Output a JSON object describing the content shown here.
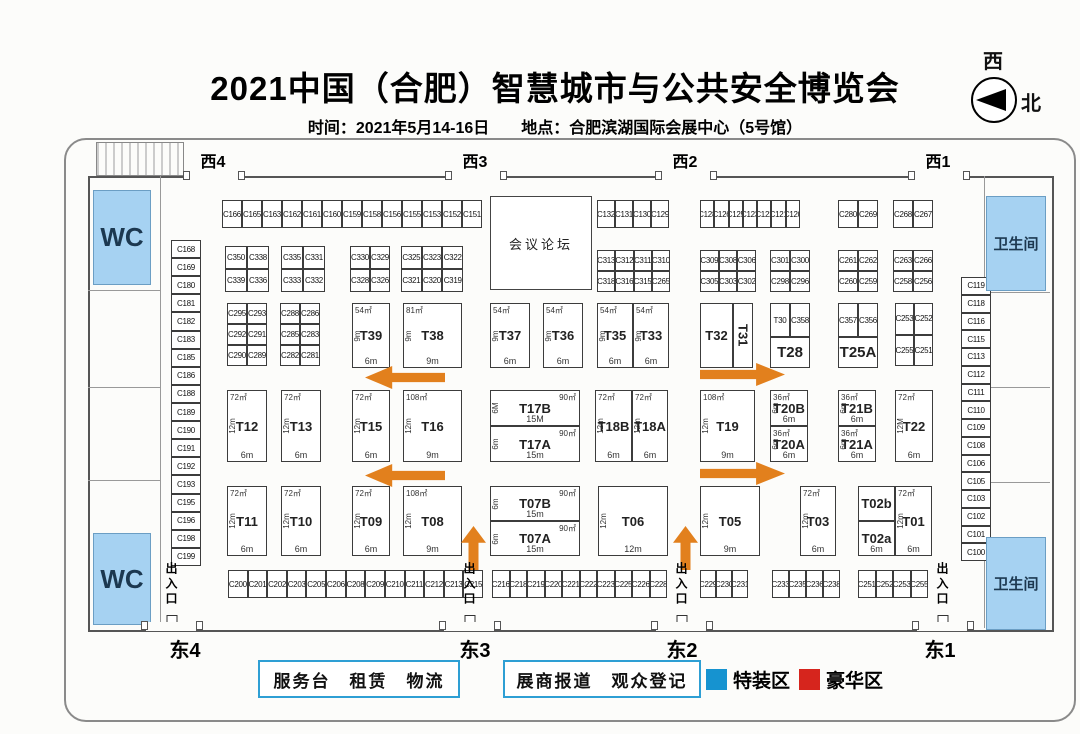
{
  "header": {
    "title": "2021中国（合肥）智慧城市与公共安全博览会",
    "subtitle": "时间：2021年5月14-16日　　地点：合肥滨湖国际会展中心（5号馆）",
    "compass_top": "西",
    "compass_right": "北"
  },
  "legend": {
    "service_box": "服务台　租赁　物流",
    "registration_box": "展商报道　观众登记",
    "special_zone_label": "特装区",
    "special_zone_color": "#1693d0",
    "deluxe_zone_label": "豪华区",
    "deluxe_zone_color": "#d6251d"
  },
  "colors": {
    "arrow_orange": "#e2801d",
    "wc_blue": "#a6d2f2"
  },
  "gates": {
    "top": [
      {
        "label": "西4",
        "x": 213
      },
      {
        "label": "西3",
        "x": 475
      },
      {
        "label": "西2",
        "x": 685
      },
      {
        "label": "西1",
        "x": 938
      }
    ],
    "bottom": [
      {
        "label": "东4",
        "x": 185
      },
      {
        "label": "东3",
        "x": 475
      },
      {
        "label": "东2",
        "x": 682
      },
      {
        "label": "东1",
        "x": 940
      }
    ]
  },
  "plan": {
    "entrance_label": "出入口",
    "entrances": [
      {
        "x": 163,
        "y": 562
      },
      {
        "x": 461,
        "y": 562
      },
      {
        "x": 673,
        "y": 562
      },
      {
        "x": 934,
        "y": 562
      }
    ],
    "conference": {
      "label": "会议论坛",
      "x": 490,
      "y": 196,
      "w": 102,
      "h": 94
    },
    "wc": [
      {
        "label": "WC",
        "x": 93,
        "y": 190,
        "w": 58,
        "h": 95
      },
      {
        "label": "WC",
        "x": 93,
        "y": 533,
        "w": 58,
        "h": 92
      },
      {
        "label": "卫生间",
        "x": 986,
        "y": 196,
        "w": 60,
        "h": 95
      },
      {
        "label": "卫生间",
        "x": 986,
        "y": 537,
        "w": 60,
        "h": 93
      }
    ],
    "strips": [
      {
        "x": 222,
        "y": 200,
        "w": 260,
        "h": 28,
        "cells": [
          "C166",
          "C165",
          "C163",
          "C162",
          "C161",
          "C160",
          "C159",
          "C158",
          "C156",
          "C155",
          "C153",
          "C152",
          "C151"
        ]
      },
      {
        "x": 597,
        "y": 200,
        "w": 72,
        "h": 28,
        "cells": [
          "C132",
          "C131",
          "C130",
          "C129"
        ]
      },
      {
        "x": 700,
        "y": 200,
        "w": 100,
        "h": 28,
        "cells": [
          "C128",
          "C126",
          "C125",
          "C123",
          "C122",
          "C121",
          "C120"
        ]
      },
      {
        "x": 838,
        "y": 200,
        "w": 40,
        "h": 28,
        "cells": [
          "C280",
          "C269"
        ]
      },
      {
        "x": 893,
        "y": 200,
        "w": 40,
        "h": 28,
        "cells": [
          "C268",
          "C267"
        ]
      },
      {
        "x": 171,
        "y": 240,
        "w": 30,
        "h": 326,
        "vertical": true,
        "cells": [
          "C168",
          "C169",
          "C180",
          "C181",
          "C182",
          "C183",
          "C185",
          "C186",
          "C188",
          "C189",
          "C190",
          "C191",
          "C192",
          "C193",
          "C195",
          "C196",
          "C198",
          "C199"
        ]
      },
      {
        "x": 961,
        "y": 277,
        "w": 30,
        "h": 284,
        "vertical": true,
        "cells": [
          "C119",
          "C118",
          "C116",
          "C115",
          "C113",
          "C112",
          "C111",
          "C110",
          "C109",
          "C108",
          "C106",
          "C105",
          "C103",
          "C102",
          "C101",
          "C100"
        ]
      },
      {
        "x": 228,
        "y": 570,
        "w": 255,
        "h": 28,
        "cells": [
          "C200",
          "C201",
          "C202",
          "C203",
          "C205",
          "C206",
          "C208",
          "C209",
          "C210",
          "C211",
          "C212",
          "C213",
          "C215"
        ]
      },
      {
        "x": 492,
        "y": 570,
        "w": 175,
        "h": 28,
        "cells": [
          "C216",
          "C218",
          "C219",
          "C220",
          "C221",
          "C222",
          "C223",
          "C225",
          "C226",
          "C228"
        ]
      },
      {
        "x": 700,
        "y": 570,
        "w": 48,
        "h": 28,
        "cells": [
          "C229",
          "C230",
          "C231"
        ]
      },
      {
        "x": 772,
        "y": 570,
        "w": 68,
        "h": 28,
        "cells": [
          "C233",
          "C235",
          "C236",
          "C238"
        ]
      },
      {
        "x": 858,
        "y": 570,
        "w": 70,
        "h": 28,
        "cells": [
          "C251",
          "C252",
          "C253",
          "C255"
        ]
      }
    ],
    "grids": [
      {
        "x": 225,
        "y": 246,
        "w": 44,
        "h": 46,
        "rows": [
          [
            "C350",
            "C338"
          ],
          [
            "C339",
            "C336"
          ]
        ]
      },
      {
        "x": 281,
        "y": 246,
        "w": 44,
        "h": 46,
        "rows": [
          [
            "C335",
            "C331"
          ],
          [
            "C333",
            "C332"
          ]
        ]
      },
      {
        "x": 350,
        "y": 246,
        "w": 40,
        "h": 46,
        "rows": [
          [
            "C330",
            "C329"
          ],
          [
            "C328",
            "C326"
          ]
        ]
      },
      {
        "x": 401,
        "y": 246,
        "w": 62,
        "h": 46,
        "rows": [
          [
            "C325",
            "C323",
            "C322"
          ],
          [
            "C321",
            "C320",
            "C319"
          ]
        ]
      },
      {
        "x": 597,
        "y": 250,
        "w": 73,
        "h": 42,
        "rows": [
          [
            "C313",
            "C312",
            "C311",
            "C310"
          ],
          [
            "C318",
            "C316",
            "C315",
            "C265"
          ]
        ]
      },
      {
        "x": 700,
        "y": 250,
        "w": 56,
        "h": 42,
        "rows": [
          [
            "C309",
            "C308",
            "C306"
          ],
          [
            "C305",
            "C303",
            "C302"
          ]
        ]
      },
      {
        "x": 770,
        "y": 250,
        "w": 40,
        "h": 42,
        "rows": [
          [
            "C301",
            "C300"
          ],
          [
            "C298",
            "C296"
          ]
        ]
      },
      {
        "x": 838,
        "y": 250,
        "w": 40,
        "h": 42,
        "rows": [
          [
            "C261",
            "C262"
          ],
          [
            "C260",
            "C259"
          ]
        ]
      },
      {
        "x": 893,
        "y": 250,
        "w": 40,
        "h": 42,
        "rows": [
          [
            "C263",
            "C266"
          ],
          [
            "C258",
            "C256"
          ]
        ]
      },
      {
        "x": 227,
        "y": 303,
        "w": 40,
        "h": 63,
        "rows": [
          [
            "C295",
            "C293"
          ],
          [
            "C292",
            "C291"
          ],
          [
            "C290",
            "C289"
          ]
        ]
      },
      {
        "x": 280,
        "y": 303,
        "w": 40,
        "h": 63,
        "rows": [
          [
            "C288",
            "C286"
          ],
          [
            "C285",
            "C283"
          ],
          [
            "C282",
            "C281"
          ]
        ]
      },
      {
        "x": 895,
        "y": 303,
        "w": 38,
        "h": 63,
        "rows": [
          [
            "C253",
            "C252"
          ],
          [
            "C255",
            "C251"
          ]
        ]
      },
      {
        "x": 770,
        "y": 303,
        "w": 40,
        "h": 34,
        "rows": [
          [
            "T30",
            "C358"
          ]
        ]
      },
      {
        "x": 838,
        "y": 303,
        "w": 40,
        "h": 34,
        "rows": [
          [
            "C357",
            "C356"
          ]
        ]
      }
    ],
    "tbooths": [
      {
        "l": "T39",
        "x": 352,
        "y": 303,
        "w": 38,
        "h": 65,
        "a": "54㎡",
        "s": "9m",
        "b": "6m"
      },
      {
        "l": "T38",
        "x": 403,
        "y": 303,
        "w": 59,
        "h": 65,
        "a": "81㎡",
        "s": "9m",
        "b": "9m"
      },
      {
        "l": "T37",
        "x": 490,
        "y": 303,
        "w": 40,
        "h": 65,
        "a": "54㎡",
        "s": "9m",
        "b": "6m"
      },
      {
        "l": "T36",
        "x": 543,
        "y": 303,
        "w": 40,
        "h": 65,
        "a": "54㎡",
        "s": "9m",
        "b": "6m"
      },
      {
        "l": "T35",
        "x": 597,
        "y": 303,
        "w": 36,
        "h": 65,
        "a": "54㎡",
        "s": "9m",
        "b": "6m"
      },
      {
        "l": "T33",
        "x": 633,
        "y": 303,
        "w": 36,
        "h": 65,
        "a": "54㎡",
        "s": "9m",
        "b": "6m"
      },
      {
        "l": "T32",
        "x": 700,
        "y": 303,
        "w": 33,
        "h": 65
      },
      {
        "l": "T31",
        "x": 733,
        "y": 303,
        "w": 20,
        "h": 65,
        "rot": true
      },
      {
        "l": "T28",
        "x": 770,
        "y": 337,
        "w": 40,
        "h": 31,
        "big": true
      },
      {
        "l": "T25A",
        "x": 838,
        "y": 337,
        "w": 40,
        "h": 31,
        "big": true
      },
      {
        "l": "T12",
        "x": 227,
        "y": 390,
        "w": 40,
        "h": 72,
        "a": "72㎡",
        "s": "12m",
        "b": "6m"
      },
      {
        "l": "T13",
        "x": 281,
        "y": 390,
        "w": 40,
        "h": 72,
        "a": "72㎡",
        "s": "12m",
        "b": "6m"
      },
      {
        "l": "T15",
        "x": 352,
        "y": 390,
        "w": 38,
        "h": 72,
        "a": "72㎡",
        "s": "12m",
        "b": "6m"
      },
      {
        "l": "T16",
        "x": 403,
        "y": 390,
        "w": 59,
        "h": 72,
        "a": "108㎡",
        "s": "12m",
        "b": "9m"
      },
      {
        "l": "T17B",
        "x": 490,
        "y": 390,
        "w": 90,
        "h": 36,
        "a": "90㎡",
        "ar": true,
        "s": "6M",
        "b": "15M"
      },
      {
        "l": "T17A",
        "x": 490,
        "y": 426,
        "w": 90,
        "h": 36,
        "a": "90㎡",
        "ar": true,
        "s": "6m",
        "b": "15m"
      },
      {
        "l": "T18B",
        "x": 595,
        "y": 390,
        "w": 37,
        "h": 72,
        "a": "72㎡",
        "s": "12m",
        "b": "6m"
      },
      {
        "l": "T18A",
        "x": 632,
        "y": 390,
        "w": 36,
        "h": 72,
        "a": "72㎡",
        "s": "12m",
        "b": "6m"
      },
      {
        "l": "T19",
        "x": 700,
        "y": 390,
        "w": 55,
        "h": 72,
        "a": "108㎡",
        "s": "12m",
        "b": "9m"
      },
      {
        "l": "T20B",
        "x": 770,
        "y": 390,
        "w": 38,
        "h": 36,
        "a": "36㎡",
        "s": "6m",
        "b": "6m"
      },
      {
        "l": "T20A",
        "x": 770,
        "y": 426,
        "w": 38,
        "h": 36,
        "a": "36㎡",
        "s": "6m",
        "b": "6m"
      },
      {
        "l": "T21B",
        "x": 838,
        "y": 390,
        "w": 38,
        "h": 36,
        "a": "36㎡",
        "s": "6m",
        "b": "6m"
      },
      {
        "l": "T21A",
        "x": 838,
        "y": 426,
        "w": 38,
        "h": 36,
        "a": "36㎡",
        "s": "6m",
        "b": "6m"
      },
      {
        "l": "T22",
        "x": 895,
        "y": 390,
        "w": 38,
        "h": 72,
        "a": "72㎡",
        "s": "12M",
        "b": "6m"
      },
      {
        "l": "T11",
        "x": 227,
        "y": 486,
        "w": 40,
        "h": 70,
        "a": "72㎡",
        "s": "12m",
        "b": "6m"
      },
      {
        "l": "T10",
        "x": 281,
        "y": 486,
        "w": 40,
        "h": 70,
        "a": "72㎡",
        "s": "12m",
        "b": "6m"
      },
      {
        "l": "T09",
        "x": 352,
        "y": 486,
        "w": 38,
        "h": 70,
        "a": "72㎡",
        "s": "12m",
        "b": "6m"
      },
      {
        "l": "T08",
        "x": 403,
        "y": 486,
        "w": 59,
        "h": 70,
        "a": "108㎡",
        "s": "12m",
        "b": "9m"
      },
      {
        "l": "T07B",
        "x": 490,
        "y": 486,
        "w": 90,
        "h": 35,
        "a": "90㎡",
        "ar": true,
        "s": "6m",
        "b": "15m"
      },
      {
        "l": "T07A",
        "x": 490,
        "y": 521,
        "w": 90,
        "h": 35,
        "a": "90㎡",
        "ar": true,
        "s": "6m",
        "b": "15m"
      },
      {
        "l": "T06",
        "x": 598,
        "y": 486,
        "w": 70,
        "h": 70,
        "s": "12m",
        "b": "12m"
      },
      {
        "l": "T05",
        "x": 700,
        "y": 486,
        "w": 60,
        "h": 70,
        "s": "12m",
        "b": "9m"
      },
      {
        "l": "T03",
        "x": 800,
        "y": 486,
        "w": 36,
        "h": 70,
        "a": "72㎡",
        "s": "12m",
        "b": "6m"
      },
      {
        "l": "T02b",
        "x": 858,
        "y": 486,
        "w": 37,
        "h": 35
      },
      {
        "l": "T02a",
        "x": 858,
        "y": 521,
        "w": 37,
        "h": 35,
        "b": "6m"
      },
      {
        "l": "T01",
        "x": 895,
        "y": 486,
        "w": 37,
        "h": 70,
        "a": "72㎡",
        "s": "12m",
        "b": "6m"
      }
    ],
    "arrows": [
      {
        "d": "left",
        "x": 365,
        "y": 366,
        "w": 80,
        "h": 23
      },
      {
        "d": "right",
        "x": 700,
        "y": 363,
        "w": 85,
        "h": 23
      },
      {
        "d": "left",
        "x": 365,
        "y": 464,
        "w": 80,
        "h": 23
      },
      {
        "d": "right",
        "x": 700,
        "y": 462,
        "w": 85,
        "h": 23
      },
      {
        "d": "up",
        "x": 461,
        "y": 526,
        "w": 25,
        "h": 44
      },
      {
        "d": "up",
        "x": 673,
        "y": 526,
        "w": 25,
        "h": 44
      }
    ]
  }
}
